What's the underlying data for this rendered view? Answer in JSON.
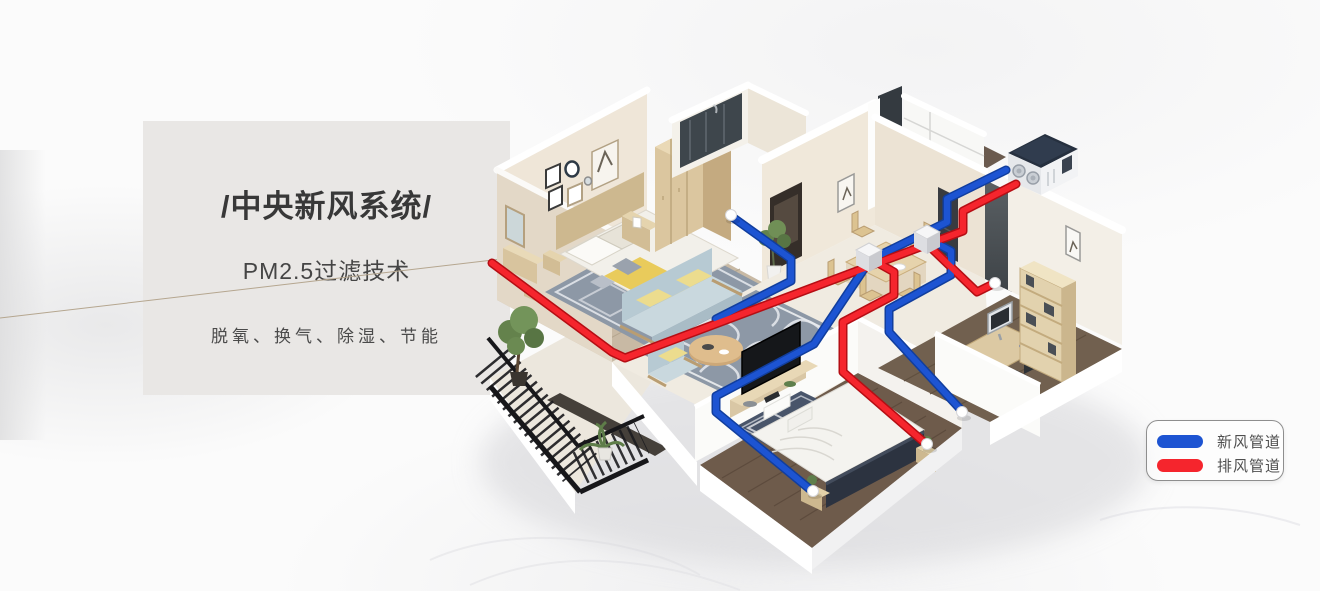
{
  "panel": {
    "title": "/中央新风系统/",
    "subtitle": "PM2.5过滤技术",
    "features": "脱氧、换气、除湿、节能"
  },
  "legend": {
    "items": [
      {
        "label": "新风管道",
        "color": "#1d54d2"
      },
      {
        "label": "排风管道",
        "color": "#f5252d"
      }
    ]
  },
  "illustration": {
    "type": "isometric-apartment-ventilation-cutaway",
    "fresh_air_color": "#1d54d2",
    "exhaust_color": "#f5252d",
    "rooms": [
      "master-bedroom",
      "bathroom",
      "hallway",
      "kitchen",
      "dining-area",
      "living-room",
      "second-bedroom",
      "study",
      "balcony"
    ],
    "equipment": [
      "heat-recovery-ventilator",
      "duct-junction-box",
      "duct-junction-box",
      "ceiling-vent",
      "ceiling-vent",
      "ceiling-vent",
      "ceiling-vent",
      "ceiling-vent"
    ]
  }
}
